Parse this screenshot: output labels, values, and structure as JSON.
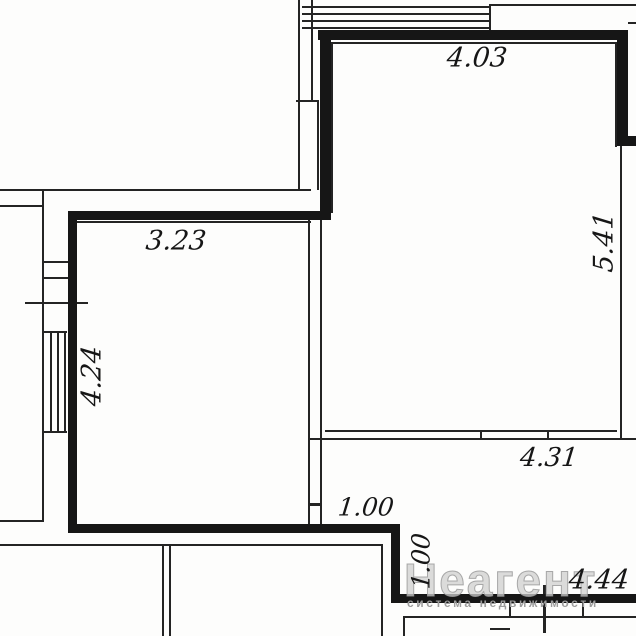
{
  "colors": {
    "background": "#fdfdfc",
    "wall": "#161616",
    "thin_line": "#242424",
    "dimension_text": "#161616",
    "watermark_main": "#cfcfcf",
    "watermark_sub": "#9c9c9c"
  },
  "watermark": {
    "brand": "Неагент",
    "tagline": "система недвижимости"
  },
  "dimensions": [
    {
      "name": "dim-top-room-width",
      "label": "4.03",
      "x": 477,
      "y": 58,
      "rotate": 0,
      "size": 27
    },
    {
      "name": "dim-top-room-height",
      "label": "5.41",
      "x": 604,
      "y": 242,
      "rotate": -90,
      "size": 27
    },
    {
      "name": "dim-left-room-width",
      "label": "3.23",
      "x": 176,
      "y": 241,
      "rotate": 0,
      "size": 27
    },
    {
      "name": "dim-left-room-height",
      "label": "4.24",
      "x": 92,
      "y": 376,
      "rotate": -90,
      "size": 27
    },
    {
      "name": "dim-hall-width",
      "label": "4.31",
      "x": 549,
      "y": 458,
      "rotate": 0,
      "size": 26
    },
    {
      "name": "dim-step-width",
      "label": "1.00",
      "x": 366,
      "y": 507,
      "rotate": 0,
      "size": 25
    },
    {
      "name": "dim-step-height",
      "label": "1.00",
      "x": 421,
      "y": 561,
      "rotate": -90,
      "size": 25
    },
    {
      "name": "dim-bottom-wall-width",
      "label": "4.44",
      "x": 599,
      "y": 580,
      "rotate": 0,
      "size": 27
    }
  ],
  "plan": {
    "thick_walls": [
      {
        "name": "wall-big-room-top",
        "x": 318,
        "y": 30,
        "w": 310,
        "h": 10
      },
      {
        "name": "wall-big-room-left",
        "x": 320,
        "y": 30,
        "w": 11,
        "h": 190
      },
      {
        "name": "wall-big-room-right",
        "x": 617,
        "y": 30,
        "w": 11,
        "h": 114
      },
      {
        "name": "wall-big-room-jog",
        "x": 617,
        "y": 136,
        "w": 19,
        "h": 10
      },
      {
        "name": "wall-left-room-top",
        "x": 68,
        "y": 211,
        "w": 263,
        "h": 9
      },
      {
        "name": "wall-left-room-left",
        "x": 68,
        "y": 211,
        "w": 9,
        "h": 322
      },
      {
        "name": "wall-left-room-bottom",
        "x": 68,
        "y": 524,
        "w": 332,
        "h": 9
      },
      {
        "name": "wall-step",
        "x": 391,
        "y": 524,
        "w": 9,
        "h": 78
      },
      {
        "name": "wall-bottom-right",
        "x": 391,
        "y": 594,
        "w": 245,
        "h": 9
      }
    ],
    "thin_lines": [
      {
        "name": "line-upper-left-h1",
        "x": 0,
        "y": 189,
        "w": 311,
        "h": 2
      },
      {
        "name": "line-upper-left-h2",
        "x": 0,
        "y": 205,
        "w": 44,
        "h": 2
      },
      {
        "name": "line-left-outer-vert",
        "x": 42,
        "y": 189,
        "w": 2,
        "h": 333
      },
      {
        "name": "line-left-bottom-cap",
        "x": 0,
        "y": 520,
        "w": 44,
        "h": 2
      },
      {
        "name": "line-lower-long-h",
        "x": 0,
        "y": 544,
        "w": 383,
        "h": 2
      },
      {
        "name": "line-lower-vert-right",
        "x": 381,
        "y": 544,
        "w": 2,
        "h": 92
      },
      {
        "name": "line-lower-partition-1",
        "x": 162,
        "y": 546,
        "w": 2,
        "h": 90
      },
      {
        "name": "line-lower-partition-2",
        "x": 169,
        "y": 546,
        "w": 2,
        "h": 90
      },
      {
        "name": "line-mid-wall-left",
        "x": 308,
        "y": 220,
        "w": 2,
        "h": 305
      },
      {
        "name": "line-mid-wall-right",
        "x": 320,
        "y": 220,
        "w": 2,
        "h": 305
      },
      {
        "name": "line-mid-wall-tick",
        "x": 308,
        "y": 503,
        "w": 14,
        "h": 3
      },
      {
        "name": "line-big-room-inner-bot",
        "x": 325,
        "y": 430,
        "w": 292,
        "h": 2
      },
      {
        "name": "line-below-big-room",
        "x": 308,
        "y": 438,
        "w": 328,
        "h": 2
      },
      {
        "name": "line-window-tick-1",
        "x": 480,
        "y": 430,
        "w": 2,
        "h": 10
      },
      {
        "name": "line-window-tick-2",
        "x": 547,
        "y": 430,
        "w": 2,
        "h": 10
      },
      {
        "name": "line-right-inner-vert",
        "x": 620,
        "y": 146,
        "w": 2,
        "h": 294
      },
      {
        "name": "line-right-inner-face",
        "x": 615,
        "y": 42,
        "w": 2,
        "h": 105
      },
      {
        "name": "line-top-inner-face",
        "x": 331,
        "y": 42,
        "w": 286,
        "h": 2
      },
      {
        "name": "line-left-inner-face",
        "x": 331,
        "y": 42,
        "w": 2,
        "h": 171
      },
      {
        "name": "line-left-room-inner-top",
        "x": 75,
        "y": 221,
        "w": 236,
        "h": 2
      },
      {
        "name": "line-top-band-1",
        "x": 302,
        "y": 6,
        "w": 188,
        "h": 2
      },
      {
        "name": "line-top-band-2",
        "x": 302,
        "y": 13,
        "w": 188,
        "h": 2
      },
      {
        "name": "line-top-band-3",
        "x": 302,
        "y": 20,
        "w": 188,
        "h": 2
      },
      {
        "name": "line-top-band-4",
        "x": 302,
        "y": 27,
        "w": 188,
        "h": 2
      },
      {
        "name": "line-top-band-end",
        "x": 489,
        "y": 5,
        "w": 2,
        "h": 26
      },
      {
        "name": "line-top-right-edge",
        "x": 489,
        "y": 4,
        "w": 147,
        "h": 2
      },
      {
        "name": "line-top-right-stub",
        "x": 628,
        "y": 22,
        "w": 8,
        "h": 2
      },
      {
        "name": "line-top-col-left",
        "x": 298,
        "y": 0,
        "w": 2,
        "h": 102
      },
      {
        "name": "line-top-col-right",
        "x": 311,
        "y": 0,
        "w": 2,
        "h": 102
      },
      {
        "name": "line-top-col-div",
        "x": 296,
        "y": 100,
        "w": 23,
        "h": 2
      },
      {
        "name": "line-top-col2-left",
        "x": 298,
        "y": 101,
        "w": 2,
        "h": 89
      },
      {
        "name": "line-top-col2-right",
        "x": 317,
        "y": 101,
        "w": 2,
        "h": 89
      },
      {
        "name": "line-left-wall-div-1",
        "x": 43,
        "y": 261,
        "w": 34,
        "h": 2
      },
      {
        "name": "line-left-wall-div-2",
        "x": 43,
        "y": 277,
        "w": 34,
        "h": 2
      },
      {
        "name": "line-left-wall-tick",
        "x": 25,
        "y": 302,
        "w": 63,
        "h": 2
      },
      {
        "name": "line-window-pane-1",
        "x": 50,
        "y": 332,
        "w": 2,
        "h": 101
      },
      {
        "name": "line-window-pane-2",
        "x": 57,
        "y": 332,
        "w": 2,
        "h": 101
      },
      {
        "name": "line-window-pane-3",
        "x": 64,
        "y": 332,
        "w": 2,
        "h": 101
      },
      {
        "name": "line-window-cap-top",
        "x": 43,
        "y": 331,
        "w": 24,
        "h": 2
      },
      {
        "name": "line-window-cap-bottom",
        "x": 43,
        "y": 431,
        "w": 24,
        "h": 2
      },
      {
        "name": "line-balcony-h",
        "x": 403,
        "y": 616,
        "w": 233,
        "h": 2
      },
      {
        "name": "line-balcony-left",
        "x": 403,
        "y": 616,
        "w": 2,
        "h": 20
      },
      {
        "name": "line-balcony-tick-1",
        "x": 509,
        "y": 603,
        "w": 2,
        "h": 14
      },
      {
        "name": "line-balcony-tick-2",
        "x": 582,
        "y": 603,
        "w": 2,
        "h": 14
      },
      {
        "name": "line-balcony-divider",
        "x": 543,
        "y": 585,
        "w": 3,
        "h": 48
      },
      {
        "name": "line-balcony-stub",
        "x": 490,
        "y": 628,
        "w": 20,
        "h": 2
      }
    ]
  }
}
